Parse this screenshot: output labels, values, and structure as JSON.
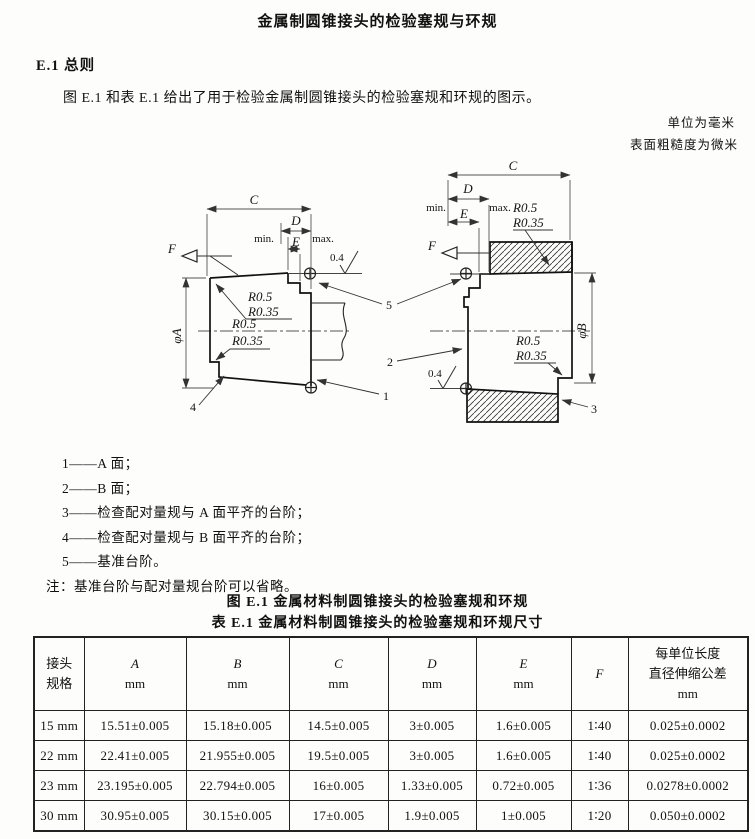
{
  "page": {
    "title": "金属制圆锥接头的检验塞规与环规",
    "section_heading": "E.1  总则",
    "paragraph": "图 E.1 和表 E.1 给出了用于检验金属制圆锥接头的检验塞规和环规的图示。",
    "unit_note_mm": "单位为毫米",
    "unit_note_roughness": "表面粗糙度为微米",
    "figure_caption": "图 E.1  金属材料制圆锥接头的检验塞规和环规",
    "table_caption": "表 E.1  金属材料制圆锥接头的检验塞规和环规尺寸"
  },
  "figure": {
    "dim_c": "C",
    "dim_d": "D",
    "dim_e": "E",
    "taper_ref": "F",
    "min_label": "min.",
    "max_label": "max.",
    "dia_a": "φA",
    "dia_b": "φB",
    "radius_1": "R0.5",
    "radius_2": "R0.35",
    "roughness": "0.4",
    "callout_1": "1",
    "callout_2": "2",
    "callout_3": "3",
    "callout_4": "4",
    "callout_5": "5"
  },
  "legend": {
    "items": [
      "1——A 面；",
      "2——B 面；",
      "3——检查配对量规与 A 面平齐的台阶；",
      "4——检查配对量规与 B 面平齐的台阶；",
      "5——基准台阶。"
    ],
    "note": "注：基准台阶与配对量规台阶可以省略。"
  },
  "table": {
    "col_spec": "接头\n规格",
    "col_last": "每单位长度\n直径伸缩公差\nmm",
    "dims": [
      {
        "letter": "A",
        "unit": "mm"
      },
      {
        "letter": "B",
        "unit": "mm"
      },
      {
        "letter": "C",
        "unit": "mm"
      },
      {
        "letter": "D",
        "unit": "mm"
      },
      {
        "letter": "E",
        "unit": "mm"
      },
      {
        "letter": "F",
        "unit": ""
      }
    ],
    "rows": [
      [
        "15 mm",
        "15.51±0.005",
        "15.18±0.005",
        "14.5±0.005",
        "3±0.005",
        "1.6±0.005",
        "1∶40",
        "0.025±0.0002"
      ],
      [
        "22 mm",
        "22.41±0.005",
        "21.955±0.005",
        "19.5±0.005",
        "3±0.005",
        "1.6±0.005",
        "1∶40",
        "0.025±0.0002"
      ],
      [
        "23 mm",
        "23.195±0.005",
        "22.794±0.005",
        "16±0.005",
        "1.33±0.005",
        "0.72±0.005",
        "1∶36",
        "0.0278±0.0002"
      ],
      [
        "30 mm",
        "30.95±0.005",
        "30.15±0.005",
        "17±0.005",
        "1.9±0.005",
        "1±0.005",
        "1∶20",
        "0.050±0.0002"
      ]
    ]
  }
}
